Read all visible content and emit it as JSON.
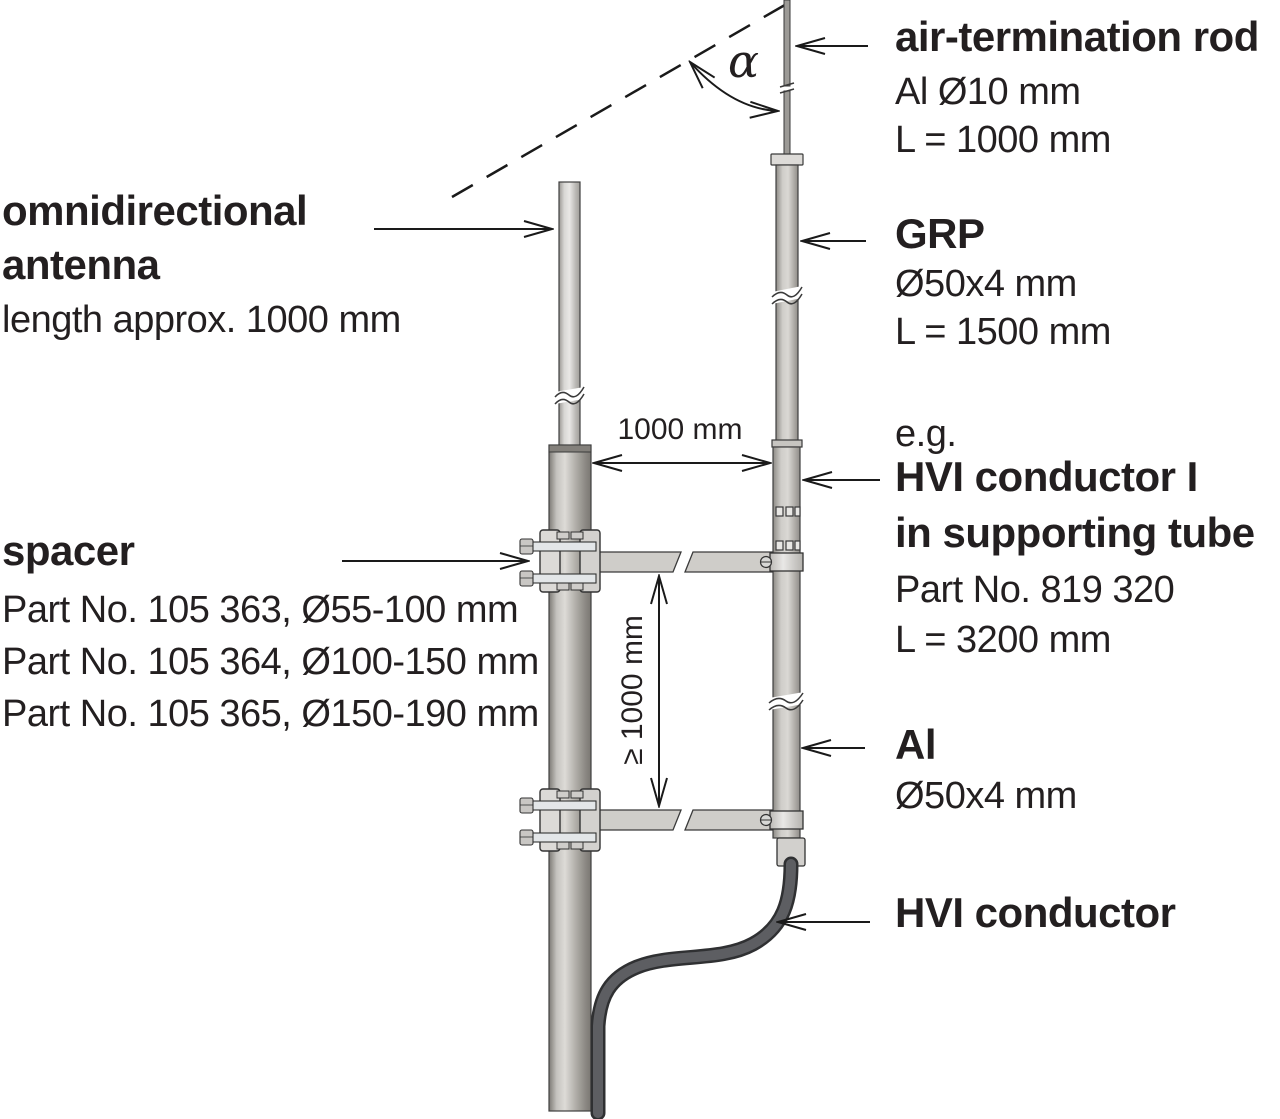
{
  "labels": {
    "antenna": {
      "line1": "omnidirectional",
      "line2": "antenna",
      "detail1": "length approx. 1000 mm"
    },
    "spacer": {
      "title": "spacer",
      "detail1": "Part No. 105 363, Ø55-100 mm",
      "detail2": "Part No. 105 364, Ø100-150 mm",
      "detail3": "Part No. 105 365, Ø150-190 mm"
    },
    "air_rod": {
      "title": "air-termination rod",
      "detail1": "Al Ø10 mm",
      "detail2": "L = 1000 mm"
    },
    "grp": {
      "title": "GRP",
      "detail1": "Ø50x4 mm",
      "detail2": "L = 1500 mm"
    },
    "hvi_tube": {
      "prefix": "e.g.",
      "title_line1": "HVI conductor I",
      "title_line2": "in supporting tube",
      "detail1": "Part No. 819 320",
      "detail2": "L = 3200 mm"
    },
    "al": {
      "title": "Al",
      "detail1": "Ø50x4 mm"
    },
    "hvi_conductor": {
      "title": "HVI conductor"
    }
  },
  "dimensions": {
    "horizontal": "1000 mm",
    "vertical": "≥ 1000 mm",
    "angle": "α"
  },
  "colors": {
    "background": "#ffffff",
    "ink": "#231f20",
    "line": "#1a1a1a",
    "tube_light": "#e6e4e1",
    "tube_mid": "#b5b2ad",
    "tube_dark": "#87847f",
    "cable_outline": "#2f3032",
    "cable_fill": "#5d5e62",
    "clamp_fill": "#d9d8d5"
  }
}
